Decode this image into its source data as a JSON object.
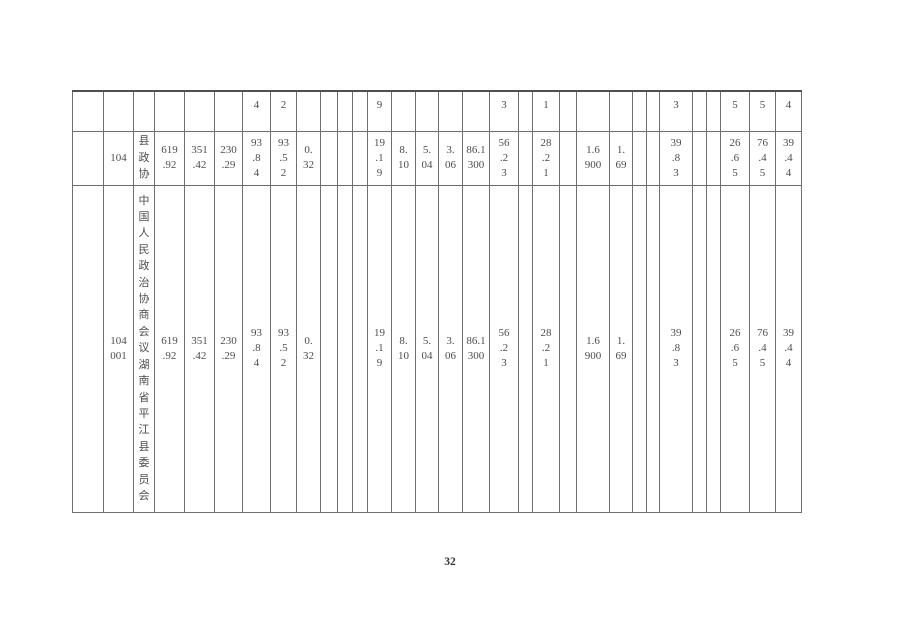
{
  "page": {
    "number": "32"
  },
  "colors": {
    "background": "#ffffff",
    "grid": "#6f6f6f",
    "grid_heavy": "#4f4f4f",
    "text": "#4d4d4d",
    "page_number": "#333333"
  },
  "table": {
    "num_columns": 31,
    "rows": [
      {
        "name": "row-carryover-fragments",
        "align": "top",
        "cells": [
          {
            "col": 6,
            "lines": [
              "4"
            ]
          },
          {
            "col": 7,
            "lines": [
              "2"
            ]
          },
          {
            "col": 12,
            "lines": [
              "9"
            ]
          },
          {
            "col": 17,
            "lines": [
              "3"
            ]
          },
          {
            "col": 19,
            "lines": [
              "1"
            ]
          },
          {
            "col": 25,
            "lines": [
              "3"
            ]
          },
          {
            "col": 28,
            "lines": [
              "5"
            ]
          },
          {
            "col": 29,
            "lines": [
              "5"
            ]
          },
          {
            "col": 30,
            "lines": [
              "4"
            ]
          }
        ]
      },
      {
        "name": "row-104",
        "cells": [
          {
            "col": 1,
            "value": "104",
            "lines": [
              "104"
            ]
          },
          {
            "col": 2,
            "value": "县政协",
            "vertical": true
          },
          {
            "col": 3,
            "value": "619.92",
            "lines": [
              "619",
              ".92"
            ]
          },
          {
            "col": 4,
            "value": "351.42",
            "lines": [
              "351",
              ".42"
            ]
          },
          {
            "col": 5,
            "value": "230.29",
            "lines": [
              "230",
              ".29"
            ]
          },
          {
            "col": 6,
            "value": "93.84",
            "lines": [
              "93",
              ".8",
              "4"
            ]
          },
          {
            "col": 7,
            "value": "93.52",
            "lines": [
              "93",
              ".5",
              "2"
            ]
          },
          {
            "col": 8,
            "value": "0.32",
            "lines": [
              "0.",
              "32"
            ]
          },
          {
            "col": 12,
            "value": "19.19",
            "lines": [
              "19",
              ".1",
              "9"
            ]
          },
          {
            "col": 13,
            "value": "8.10",
            "lines": [
              "8.",
              "10"
            ]
          },
          {
            "col": 14,
            "value": "5.04",
            "lines": [
              "5.",
              "04"
            ]
          },
          {
            "col": 15,
            "value": "3.06",
            "lines": [
              "3.",
              "06"
            ]
          },
          {
            "col": 16,
            "value": "86.1300",
            "lines": [
              "86.1",
              "300"
            ]
          },
          {
            "col": 17,
            "value": "56.23",
            "lines": [
              "56",
              ".2",
              "3"
            ]
          },
          {
            "col": 19,
            "value": "28.21",
            "lines": [
              "28",
              ".2",
              "1"
            ]
          },
          {
            "col": 21,
            "value": "1.6900",
            "lines": [
              "1.6",
              "900"
            ]
          },
          {
            "col": 22,
            "value": "1.69",
            "lines": [
              "1.",
              "69"
            ]
          },
          {
            "col": 25,
            "value": "39.83",
            "lines": [
              "39",
              ".8",
              "3"
            ]
          },
          {
            "col": 28,
            "value": "26.65",
            "lines": [
              "26",
              ".6",
              "5"
            ]
          },
          {
            "col": 29,
            "value": "76.45",
            "lines": [
              "76",
              ".4",
              "5"
            ]
          },
          {
            "col": 30,
            "value": "39.44",
            "lines": [
              "39",
              ".4",
              "4"
            ]
          }
        ]
      },
      {
        "name": "row-104001",
        "cells": [
          {
            "col": 1,
            "value": "104001",
            "lines": [
              "104",
              "001"
            ]
          },
          {
            "col": 2,
            "value": "中国人民政治协商会议湖南省平江县委员会",
            "vertical": true
          },
          {
            "col": 3,
            "value": "619.92",
            "lines": [
              "619",
              ".92"
            ]
          },
          {
            "col": 4,
            "value": "351.42",
            "lines": [
              "351",
              ".42"
            ]
          },
          {
            "col": 5,
            "value": "230.29",
            "lines": [
              "230",
              ".29"
            ]
          },
          {
            "col": 6,
            "value": "93.84",
            "lines": [
              "93",
              ".8",
              "4"
            ]
          },
          {
            "col": 7,
            "value": "93.52",
            "lines": [
              "93",
              ".5",
              "2"
            ]
          },
          {
            "col": 8,
            "value": "0.32",
            "lines": [
              "0.",
              "32"
            ]
          },
          {
            "col": 12,
            "value": "19.19",
            "lines": [
              "19",
              ".1",
              "9"
            ]
          },
          {
            "col": 13,
            "value": "8.10",
            "lines": [
              "8.",
              "10"
            ]
          },
          {
            "col": 14,
            "value": "5.04",
            "lines": [
              "5.",
              "04"
            ]
          },
          {
            "col": 15,
            "value": "3.06",
            "lines": [
              "3.",
              "06"
            ]
          },
          {
            "col": 16,
            "value": "86.1300",
            "lines": [
              "86.1",
              "300"
            ]
          },
          {
            "col": 17,
            "value": "56.23",
            "lines": [
              "56",
              ".2",
              "3"
            ]
          },
          {
            "col": 19,
            "value": "28.21",
            "lines": [
              "28",
              ".2",
              "1"
            ]
          },
          {
            "col": 21,
            "value": "1.6900",
            "lines": [
              "1.6",
              "900"
            ]
          },
          {
            "col": 22,
            "value": "1.69",
            "lines": [
              "1.",
              "69"
            ]
          },
          {
            "col": 25,
            "value": "39.83",
            "lines": [
              "39",
              ".8",
              "3"
            ]
          },
          {
            "col": 28,
            "value": "26.65",
            "lines": [
              "26",
              ".6",
              "5"
            ]
          },
          {
            "col": 29,
            "value": "76.45",
            "lines": [
              "76",
              ".4",
              "5"
            ]
          },
          {
            "col": 30,
            "value": "39.44",
            "lines": [
              "39",
              ".4",
              "4"
            ]
          }
        ]
      }
    ]
  }
}
